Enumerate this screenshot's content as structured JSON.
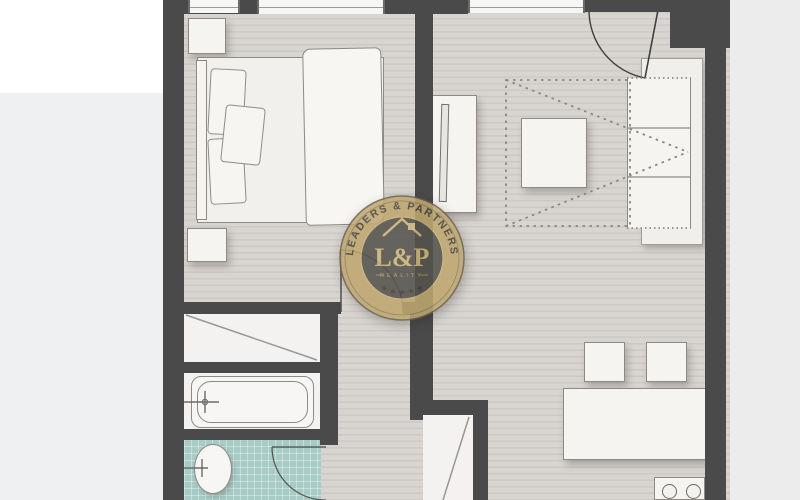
{
  "watermark": {
    "arc_text": "LEADERS & PARTNERS",
    "monogram": "L&P",
    "subtitle": "REALITY",
    "stars": "★ ★ ★ ★ ★"
  },
  "palette": {
    "wall": "#4a4a4a",
    "floor_base": "#d8d4d0",
    "floor_stripe": "#cdc9c5",
    "room": "#f3f2f0",
    "tile_floor": "#a6ccc5",
    "furniture": "#f5f4f1",
    "outline": "#8d8a86",
    "badge_gold": "#bfa76f",
    "badge_dark": "#55534c",
    "badge_text": "#cdb57a",
    "bg_left": "#eef0f2",
    "bg_right": "#ececec"
  }
}
